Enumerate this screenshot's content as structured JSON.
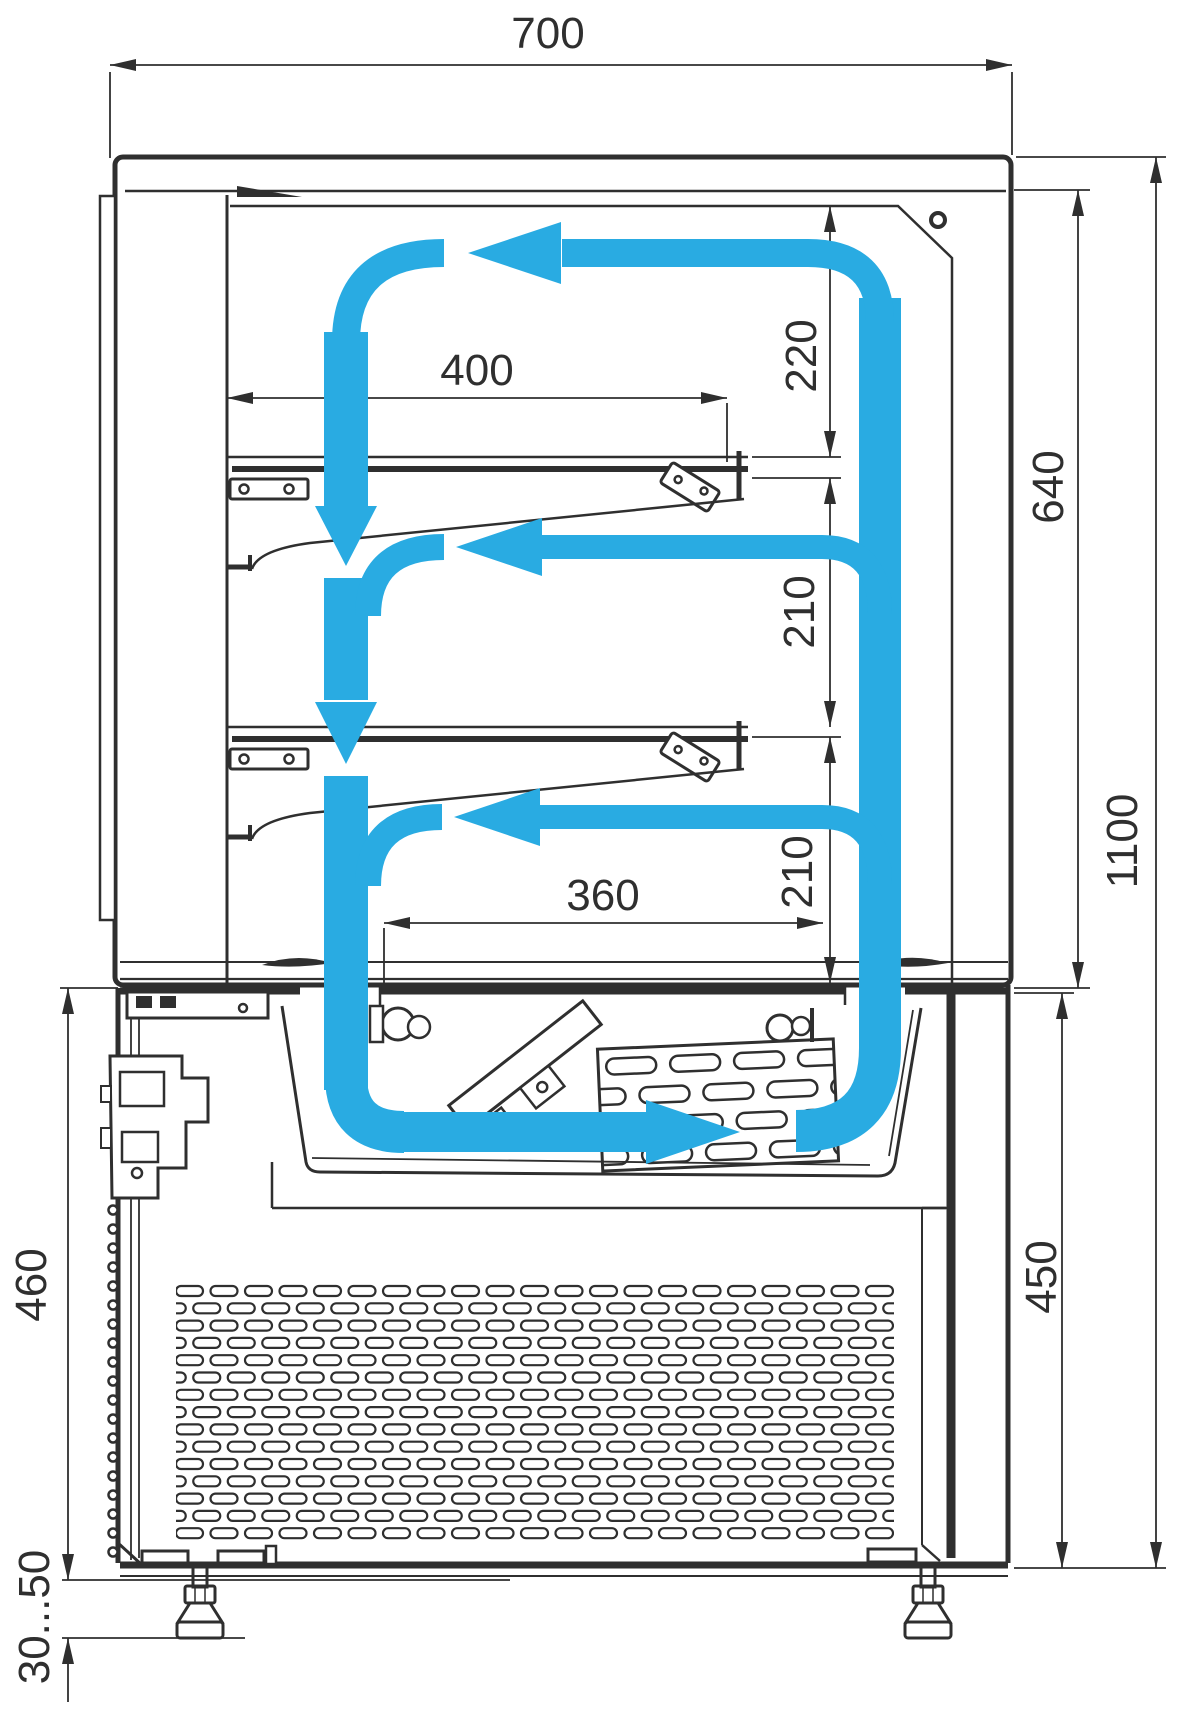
{
  "diagram": {
    "type": "technical-drawing",
    "subject": "refrigerated display case — side section with air circulation",
    "colors": {
      "line": "#2f2f2f",
      "airflow": "#29ABE2",
      "background": "#ffffff"
    },
    "units": "mm",
    "dimensions": {
      "overall_width": "700",
      "top_clearance": "220",
      "upper_zone_height": "640",
      "shelf_length": "400",
      "shelf_gap_1": "210",
      "shelf_gap_2": "210",
      "overall_height": "1100",
      "deck_opening_width": "360",
      "machine_section_height_right": "450",
      "machine_section_height_left": "460",
      "foot_adjust_range": "30...50"
    }
  }
}
